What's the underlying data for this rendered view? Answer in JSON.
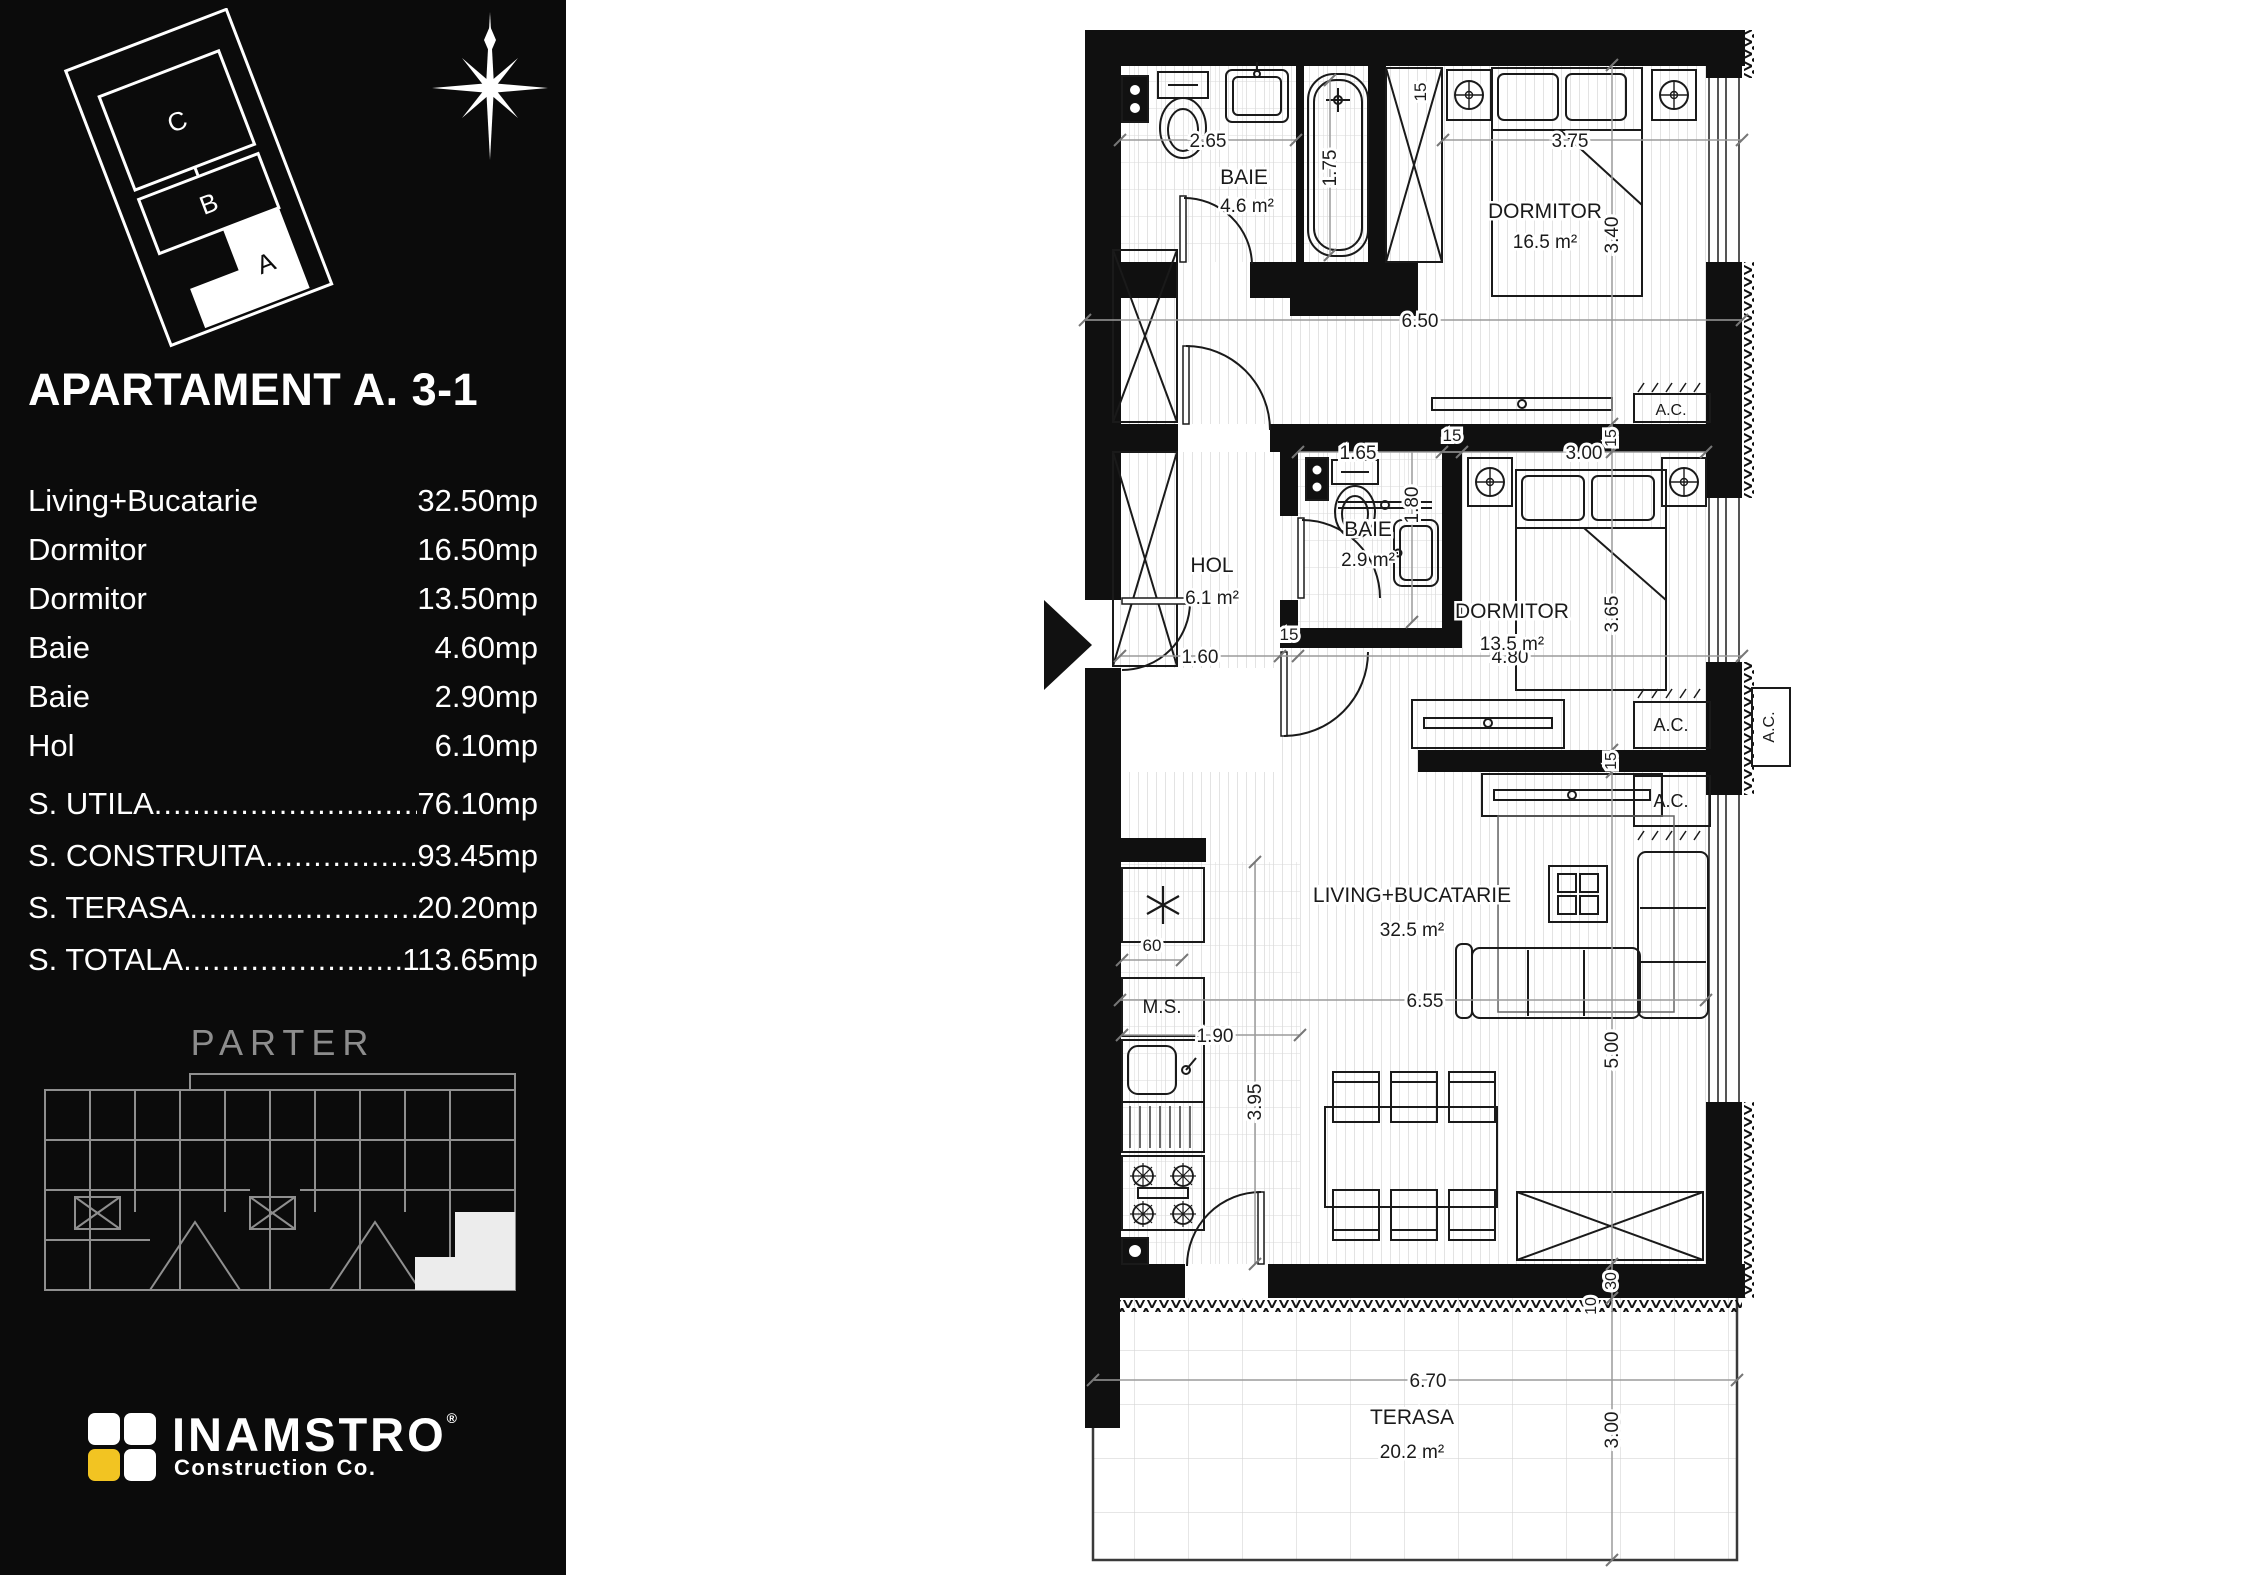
{
  "sidebar": {
    "title": "APARTAMENT A. 3-1",
    "building_icon_letters": {
      "c": "C",
      "b": "B",
      "a": "A"
    },
    "rooms": [
      {
        "label": "Living+Bucatarie",
        "value": "32.50mp"
      },
      {
        "label": "Dormitor",
        "value": "16.50mp"
      },
      {
        "label": "Dormitor",
        "value": "13.50mp"
      },
      {
        "label": "Baie",
        "value": "4.60mp"
      },
      {
        "label": "Baie",
        "value": "2.90mp"
      },
      {
        "label": "Hol",
        "value": "6.10mp"
      }
    ],
    "totals": [
      {
        "label": "S. UTILA",
        "value": "76.10mp"
      },
      {
        "label": "S. CONSTRUITA",
        "value": "93.45mp"
      },
      {
        "label": "S. TERASA",
        "value": "20.20mp"
      },
      {
        "label": "S. TOTALA",
        "value": "113.65mp"
      }
    ],
    "dots": "....................................................................",
    "floor_label": "PARTER",
    "logo": {
      "name": "INAMSTRO",
      "registered": "®",
      "subtitle": "Construction Co.",
      "accent_color": "#f2c422"
    }
  },
  "plan": {
    "rooms": {
      "baie1": {
        "name": "BAIE",
        "area": "4.6 m²"
      },
      "dormitor1": {
        "name": "DORMITOR",
        "area": "16.5 m²"
      },
      "hol": {
        "name": "HOL",
        "area": "6.1 m²"
      },
      "baie2": {
        "name": "BAIE",
        "area": "2.9 m²"
      },
      "dormitor2": {
        "name": "DORMITOR",
        "area": "13.5 m²"
      },
      "living": {
        "name": "LIVING+BUCATARIE",
        "area": "32.5 m²"
      },
      "terasa": {
        "name": "TERASA",
        "area": "20.2 m²"
      }
    },
    "dims": {
      "d265": "2.65",
      "d175": "1.75",
      "d15": "15",
      "d375": "3.75",
      "d340": "3.40",
      "d650": "6.50",
      "d165": "1.65",
      "d300": "3.00",
      "d180": "1.80",
      "d365": "3.65",
      "d160": "1.60",
      "d480": "4.80",
      "d60": "60",
      "d190": "1.90",
      "d395": "3.95",
      "d655": "6.55",
      "d500": "5.00",
      "d30": "30",
      "d10": "10",
      "d670": "6.70"
    },
    "labels": {
      "ac": "A.C.",
      "ms": "M.S."
    }
  }
}
